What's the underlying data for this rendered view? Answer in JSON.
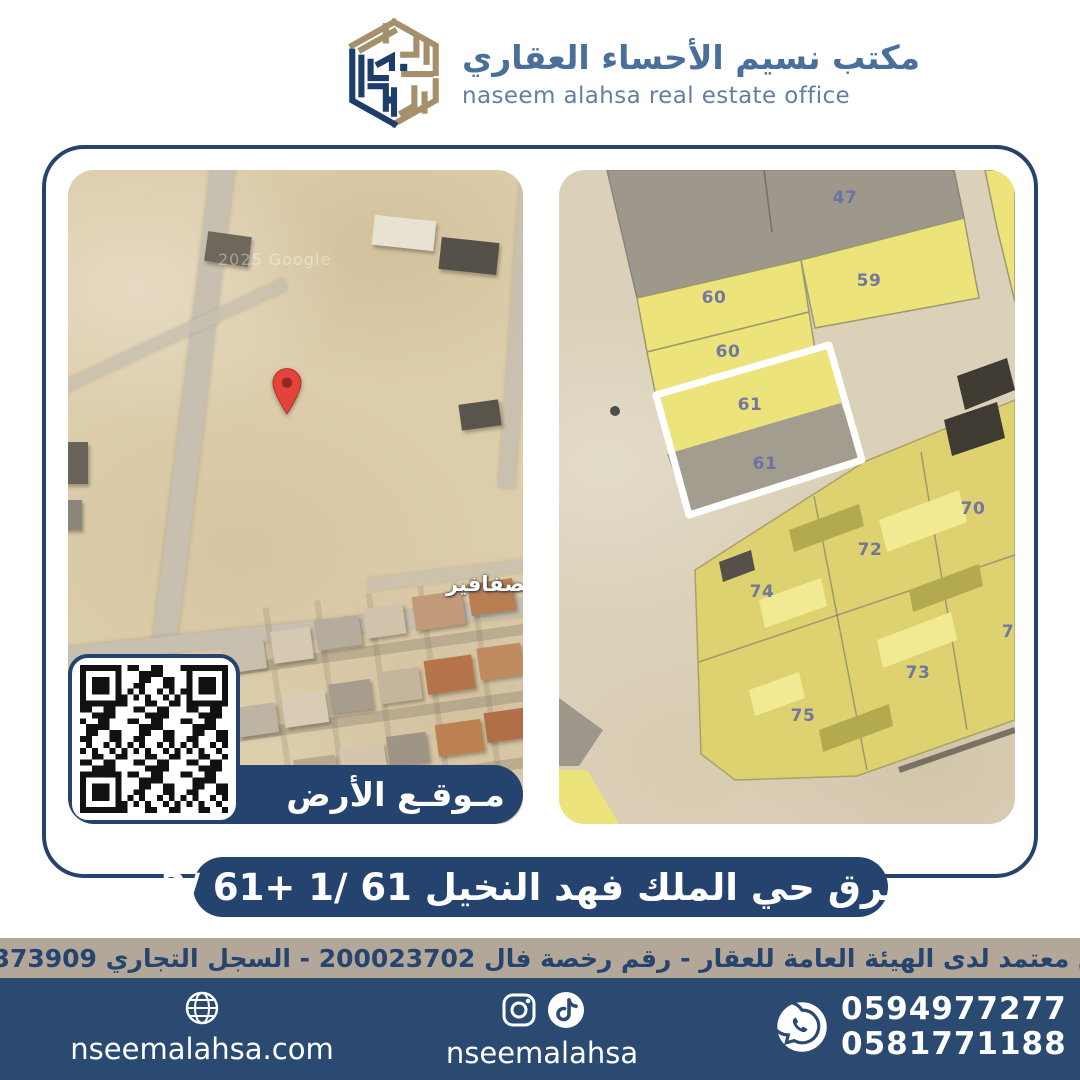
{
  "header": {
    "brand_ar": "مكتب نسيم الأحساء العقاري",
    "brand_en": "naseem alahsa real estate office"
  },
  "left_map": {
    "watermark": "2025 Google",
    "district_label": "لصفافير",
    "banner_label": "مـوقـع الأرض"
  },
  "right_map": {
    "highlighted_parcel": "61",
    "parcels": [
      {
        "label": "47",
        "x": 286,
        "y": 28
      },
      {
        "label": "59",
        "x": 310,
        "y": 111
      },
      {
        "label": "60",
        "x": 155,
        "y": 128
      },
      {
        "label": "60",
        "x": 169,
        "y": 182
      },
      {
        "label": "61",
        "x": 191,
        "y": 235
      },
      {
        "label": "61",
        "x": 206,
        "y": 294
      },
      {
        "label": "70",
        "x": 414,
        "y": 339
      },
      {
        "label": "72",
        "x": 311,
        "y": 380
      },
      {
        "label": "74",
        "x": 203,
        "y": 422
      },
      {
        "label": "73",
        "x": 359,
        "y": 503
      },
      {
        "label": "75",
        "x": 244,
        "y": 546
      },
      {
        "label": "7",
        "x": 449,
        "y": 462
      }
    ]
  },
  "title_bar": {
    "text": "شرق حي الملك فهد النخيل 61 /1 +61 /2"
  },
  "license_bar": {
    "text": "مسوق معتمد لدى الهيئة العامة للعقار - رقم رخصة فال 200023702 - السجل التجاري 2250373909"
  },
  "footer": {
    "website": "nseemalahsa.com",
    "social_handle": "nseemalahsa",
    "phone_1": "0594977277",
    "phone_2": "0581771188"
  },
  "colors": {
    "navy": "#24436e",
    "footer_navy": "#2b4a72",
    "bar_tan": "#b2a798",
    "logo_tan": "#a5906c",
    "pin_red": "#e2443b",
    "parcel_yellow": "#ece37b"
  }
}
